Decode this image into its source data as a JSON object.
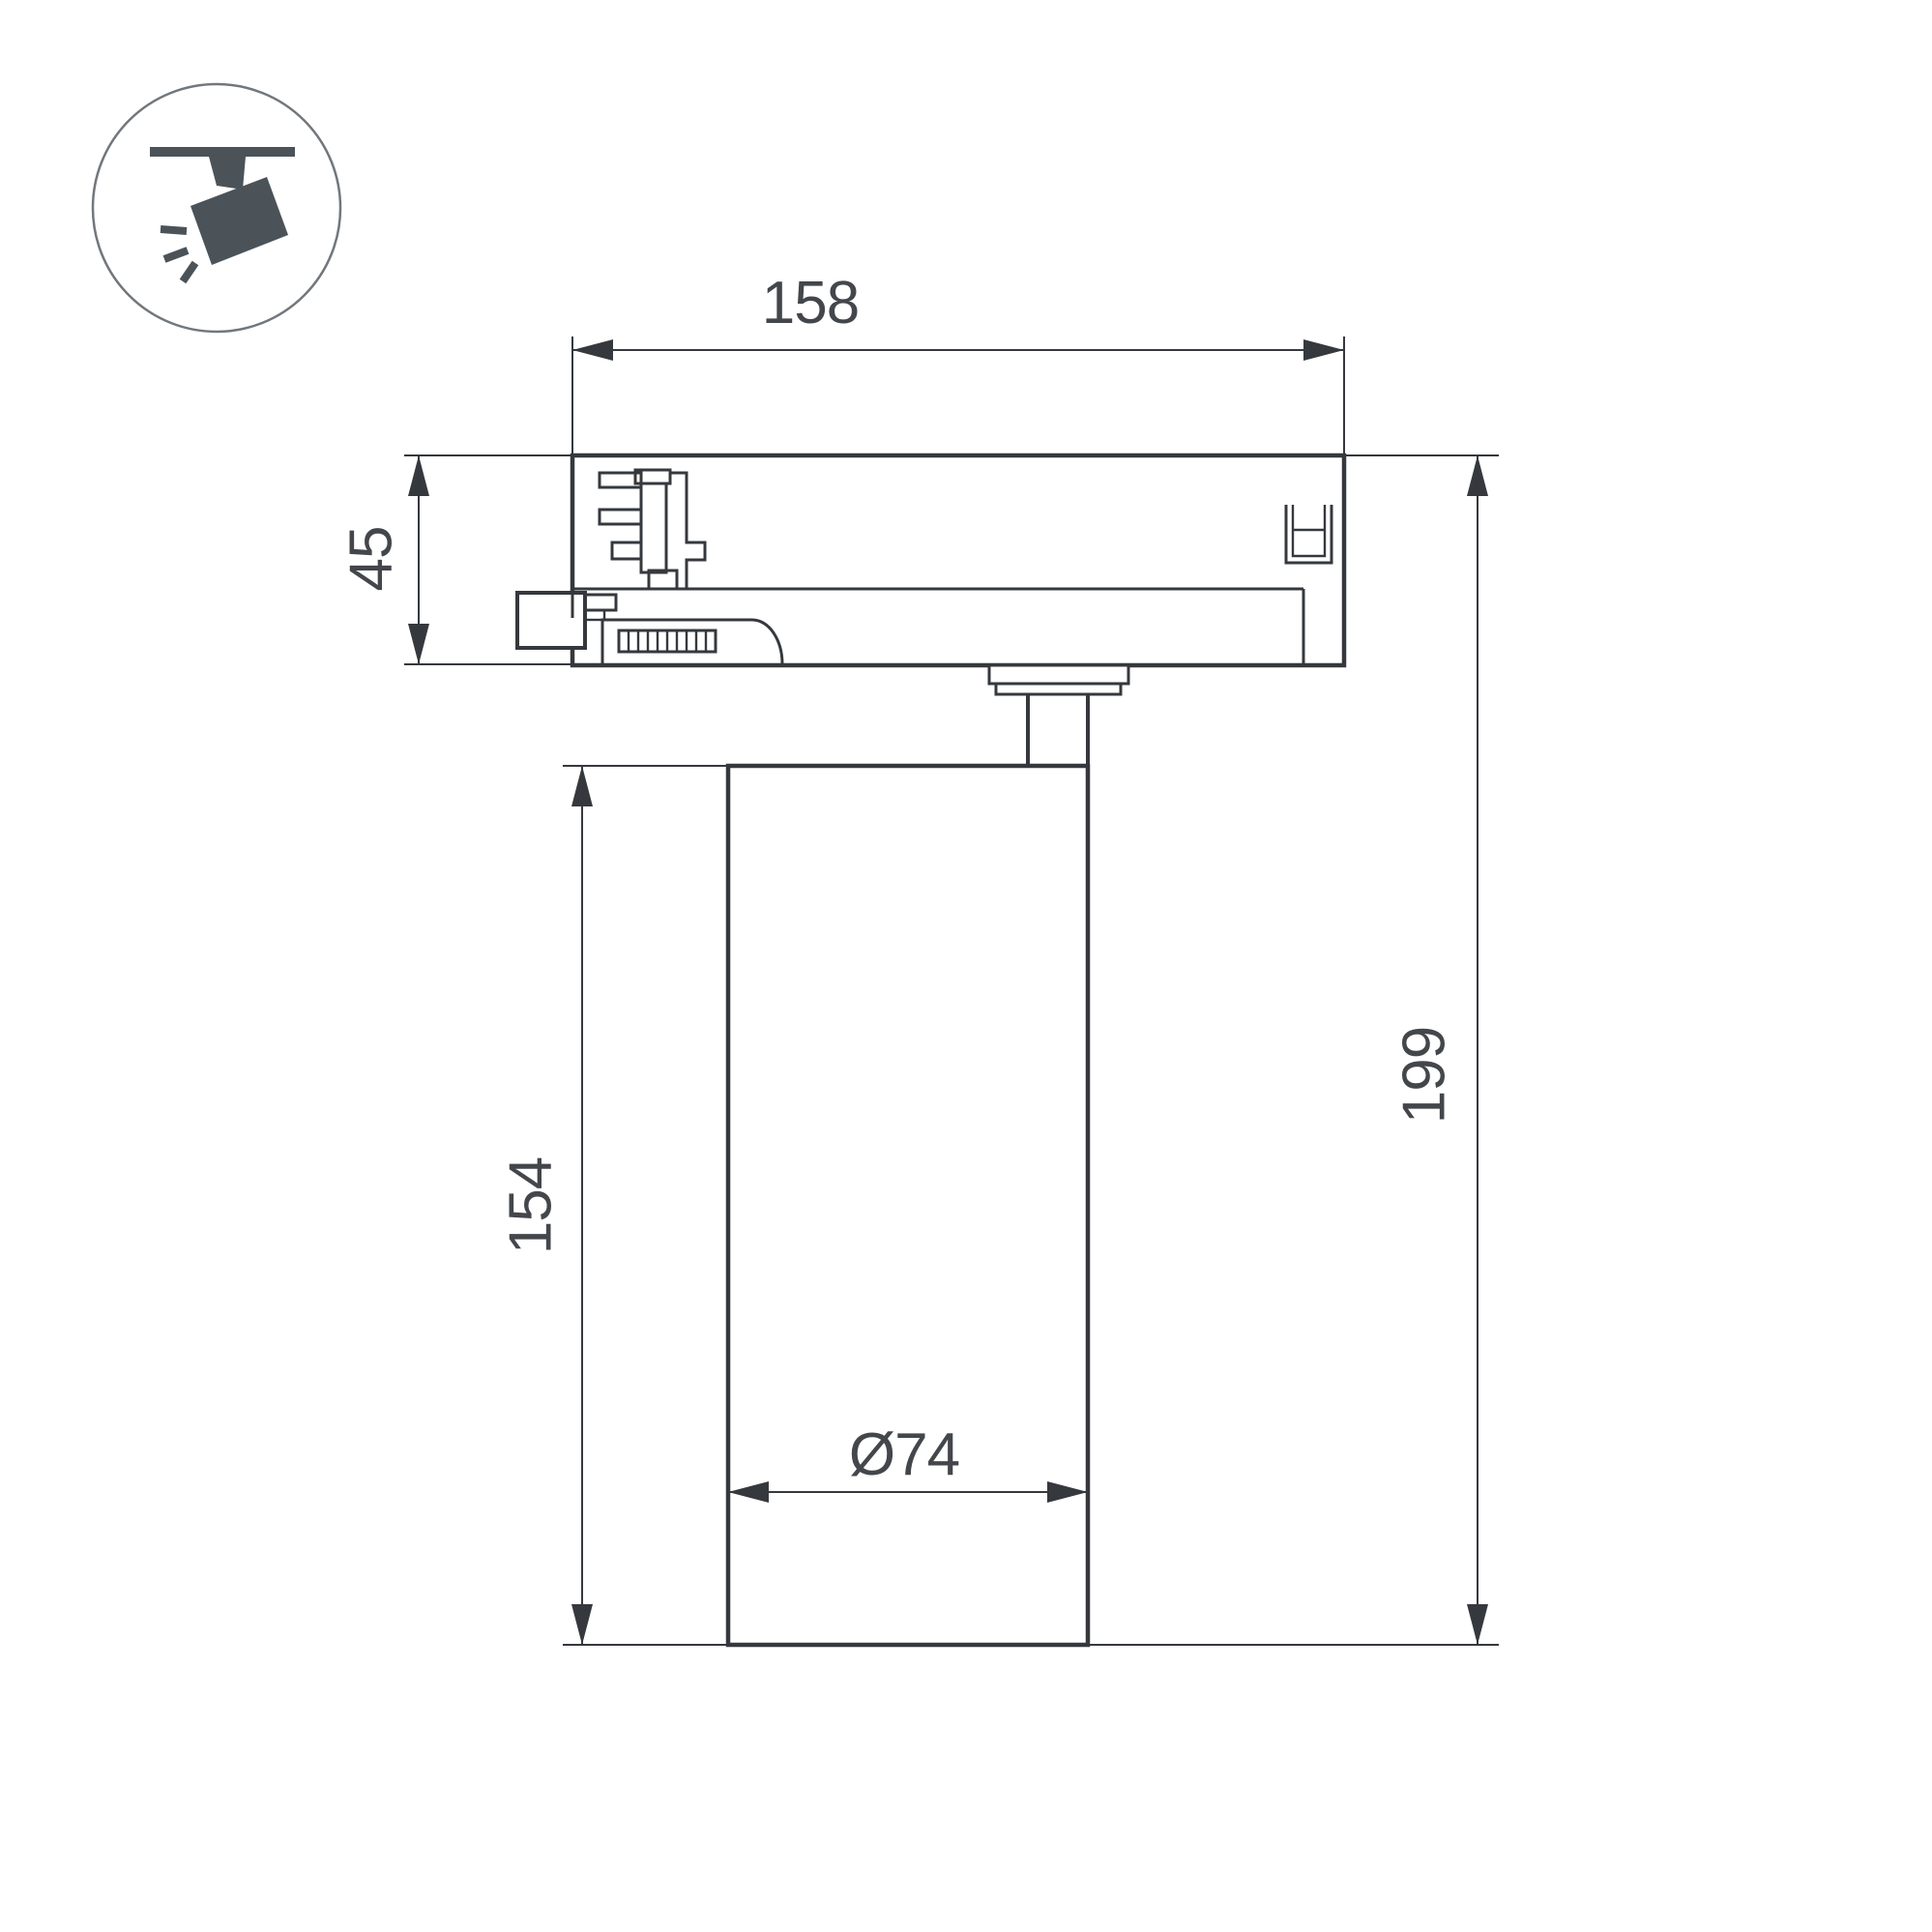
{
  "icon": {
    "name": "track-spotlight-icon"
  },
  "dimensions": {
    "adapter_width": "158",
    "adapter_height": "45",
    "body_height": "154",
    "total_height": "199",
    "body_diameter": "Ø74"
  },
  "colors": {
    "background": "#ffffff",
    "line-color": "#35393e",
    "text-color": "#43474c",
    "icon-color": "#4b5359",
    "icon-ring-color": "#71777d"
  }
}
